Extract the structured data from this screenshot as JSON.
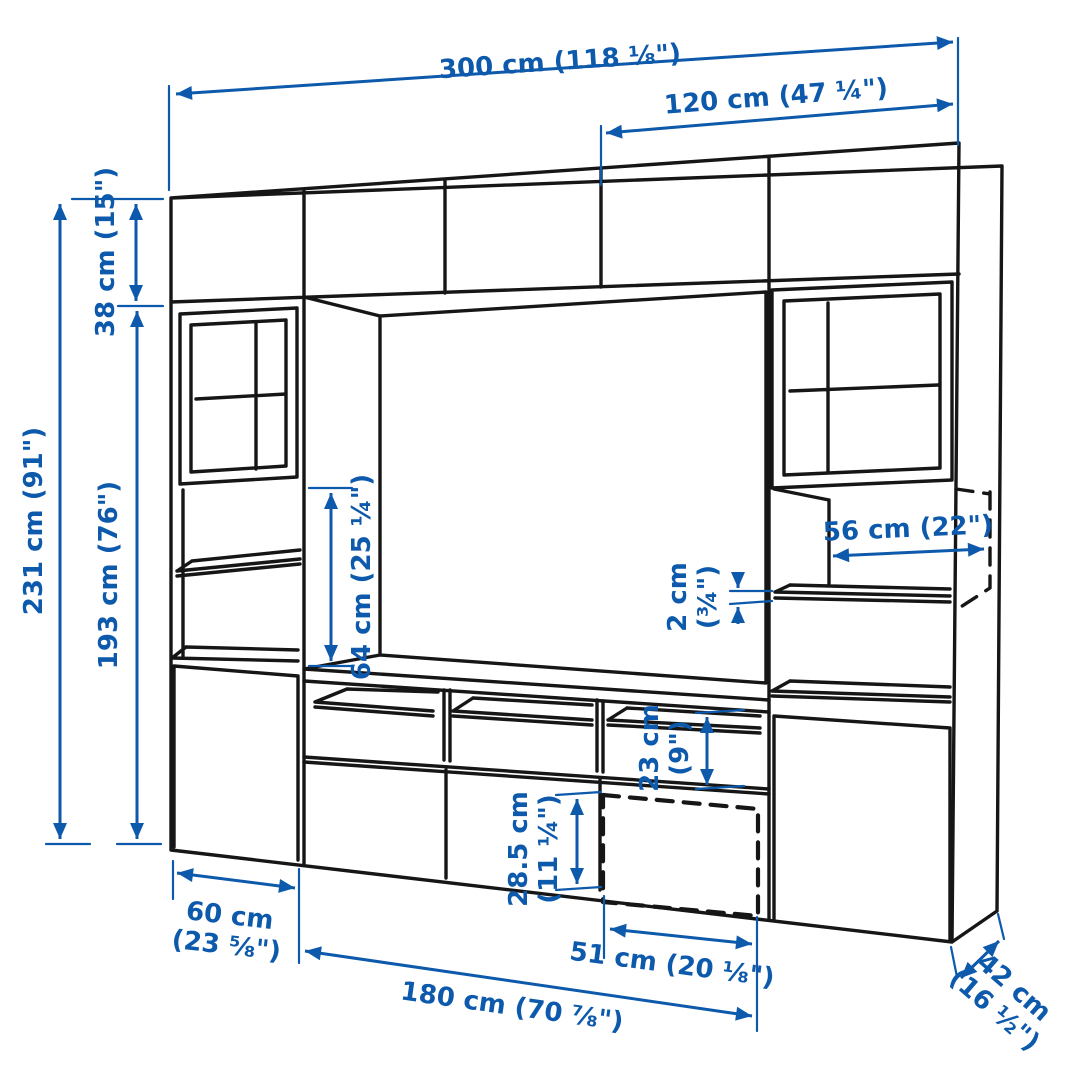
{
  "colors": {
    "dimension_blue": "#0d59ab",
    "line_black": "#161616",
    "background": "#ffffff"
  },
  "dimensions": {
    "total_width": {
      "label": "300 cm (118 ⅛\")"
    },
    "right_section_width": {
      "label": "120 cm (47 ¼\")"
    },
    "top_row_height": {
      "label": "38 cm (15\")"
    },
    "total_height": {
      "label": "231 cm (91\")"
    },
    "lower_height": {
      "label": "193 cm (76\")"
    },
    "tv_space_height": {
      "label": "64 cm (25 ¼\")"
    },
    "interior_depth": {
      "label": "56 cm (22\")"
    },
    "shelf_thickness": {
      "line1": "2 cm",
      "line2": "(¾\")"
    },
    "compartment_height": {
      "line1": "23 cm",
      "line2": "(9\")"
    },
    "drawer_front_height": {
      "line1": "28.5 cm",
      "line2": "(11 ¼\")"
    },
    "left_cabinet_width": {
      "line1": "60 cm",
      "line2": "(23 ⅝\")"
    },
    "drawer_width": {
      "label": "51 cm (20 ⅛\")"
    },
    "bench_width": {
      "label": "180 cm (70 ⅞\")"
    },
    "total_depth": {
      "line1": "42 cm",
      "line2": "(16 ½\")"
    }
  }
}
